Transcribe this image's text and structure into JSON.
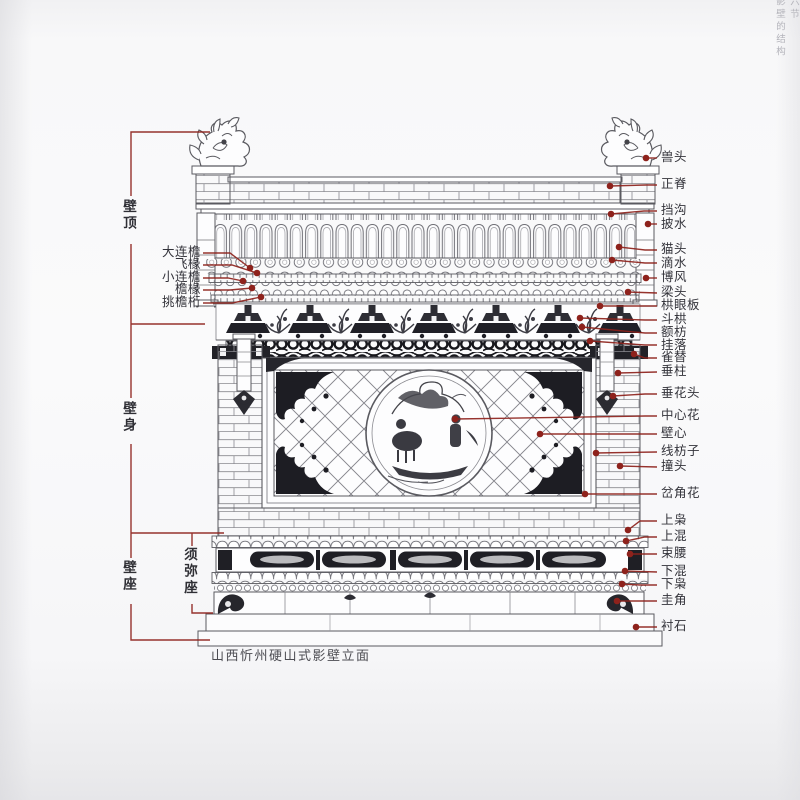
{
  "page_header": {
    "line1": "六节",
    "line2": "影壁的结构"
  },
  "caption": "山西忻州硬山式影壁立面",
  "labels": {
    "right": [
      "兽头",
      "正脊",
      "挡沟",
      "披水",
      "猫头",
      "滴水",
      "博风",
      "梁头",
      "栱眼板",
      "斗栱",
      "额枋",
      "挂落",
      "雀替",
      "垂柱",
      "垂花头",
      "中心花",
      "壁心",
      "线枋子",
      "撞头",
      "岔角花",
      "上枭",
      "上混",
      "束腰",
      "下混",
      "下枭",
      "圭角",
      "衬石"
    ],
    "left": [
      "大连檐",
      "飞椽",
      "小连檐",
      "檐椽",
      "挑檐桁"
    ],
    "groups": [
      "壁顶",
      "壁身",
      "壁座",
      "须弥座"
    ]
  },
  "colors": {
    "leader_red": "#8e221c",
    "ink": "#55555b",
    "carving_dark": "#222228",
    "paper": "#f8f8f9"
  }
}
